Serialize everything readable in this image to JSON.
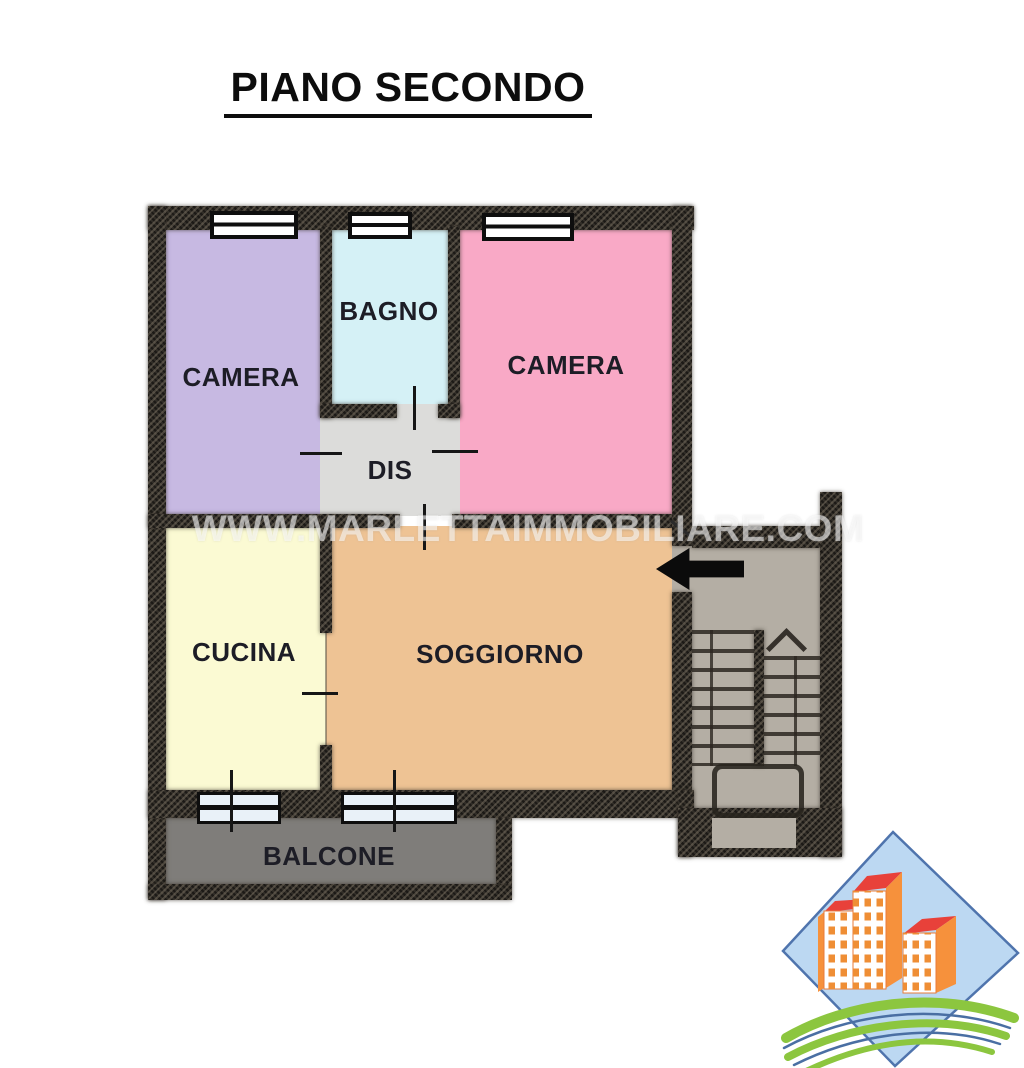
{
  "title": "PIANO SECONDO",
  "watermark": "WWW.MARLETTAIMMOBILIARE.COM",
  "rooms": {
    "camera1": {
      "label": "CAMERA",
      "color": "#c7b9e2"
    },
    "bagno": {
      "label": "BAGNO",
      "color": "#d5f1f6"
    },
    "camera2": {
      "label": "CAMERA",
      "color": "#f9a9c6"
    },
    "dis": {
      "label": "DIS",
      "color": "#dcdcda"
    },
    "cucina": {
      "label": "CUCINA",
      "color": "#fbfad3"
    },
    "soggiorno": {
      "label": "SOGGIORNO",
      "color": "#eec394"
    },
    "balcone": {
      "label": "BALCONE",
      "color": "#7f7d7a"
    }
  },
  "stairwell": {
    "interior_color": "#b4aea4"
  },
  "colors": {
    "wall": "#322e28",
    "entrance_arrow": "#0b0b0b",
    "watermark_text": "#ffffff",
    "logo_diamond": "#bcd8f2",
    "logo_diamond_border": "#4f74ad",
    "logo_roof_red": "#e8413a",
    "logo_side_orange": "#f6913c",
    "logo_window_orange": "#ef8e35",
    "logo_green": "#8cc63f",
    "logo_swoosh_blue": "#4a6fa3"
  },
  "icons": {
    "entrance_arrow": "left-arrow",
    "stairs_direction": "chevron-up",
    "logo": "real-estate-agency-logo"
  }
}
